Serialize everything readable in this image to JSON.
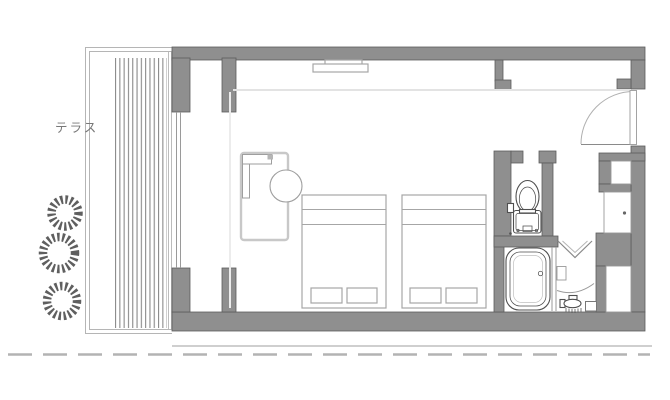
{
  "labels": {
    "terrace": "テラス"
  },
  "colors": {
    "wall_fill": "#8f8f8f",
    "wall_stroke": "#5c5c5c",
    "fixture_line": "#4f4f4f",
    "furniture_line": "#a6a6a6",
    "desk_line": "#c8c8c8",
    "thin_line": "#9a9a9a",
    "light_line": "#e3e3e3",
    "boundary_line": "#b5b5b5",
    "dash_line": "#b3b3b3",
    "slat_line": "#8a8a8a",
    "plant_line": "#5f5f5f",
    "text_color": "#787878"
  },
  "fixtures": [
    "planting",
    "louver-screen",
    "terrace-boundary",
    "window-bay",
    "tv-shelf",
    "desk-sofa",
    "chair",
    "single-bed",
    "pillow",
    "toilet",
    "bathtub",
    "washbasin-faucet",
    "folding-door",
    "entrance-swing-door",
    "storage-niche",
    "closet-cabinet",
    "pipe-shaft",
    "site-boundary-dashed"
  ]
}
